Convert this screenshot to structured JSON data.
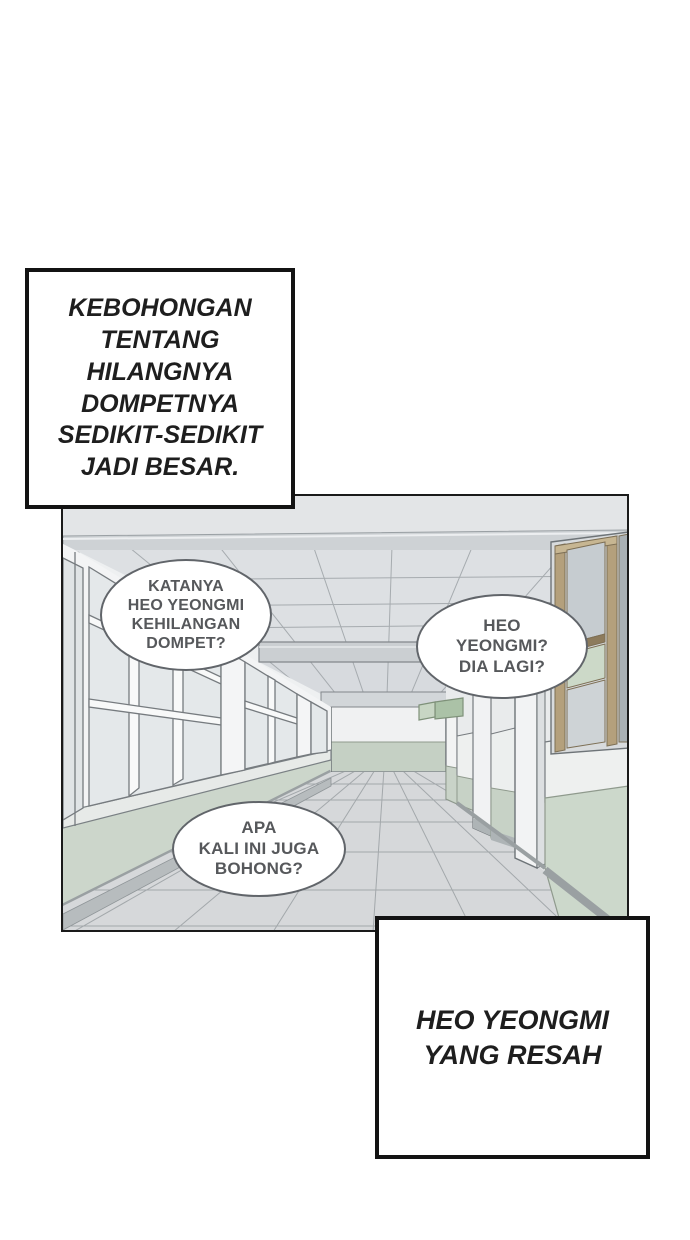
{
  "scene": {
    "label": "empty school hallway corridor, one-point perspective"
  },
  "narration": {
    "top_left": {
      "lines": [
        "KEBOHONGAN",
        "TENTANG",
        "HILANGNYA",
        "DOMPETNYA",
        "SEDIKIT-SEDIKIT",
        "JADI BESAR."
      ]
    },
    "bottom_right": {
      "lines": [
        "HEO YEONGMI",
        "YANG RESAH"
      ]
    }
  },
  "bubbles": {
    "left": {
      "lines": [
        "KATANYA",
        "HEO YEONGMI",
        "KEHILANGAN",
        "DOMPET?"
      ]
    },
    "right": {
      "lines": [
        "HEO",
        "YEONGMI?",
        "DIA LAGI?"
      ]
    },
    "bottom": {
      "lines": [
        "APA",
        "KALI INI JUGA",
        "BOHONG?"
      ]
    }
  },
  "colors": {
    "page_background": "#ffffff",
    "panel_border": "#1a1a1a",
    "narration_border": "#131313",
    "narration_text": "#1e1e1e",
    "bubble_border": "#61656a",
    "bubble_text": "#56585b",
    "ceiling_gray": "#dde0e3",
    "wall_white": "#f3f4f5",
    "wainscot_mint": "#ccd6cb",
    "end_wall_mint": "#c5d0c4",
    "floor_gray": "#d6d8da",
    "baseboard_gray": "#9aa0a2",
    "door_frame_tan": "#b4a07c",
    "sign_green": "#abc2a7",
    "outline_gray": "#71777b"
  }
}
